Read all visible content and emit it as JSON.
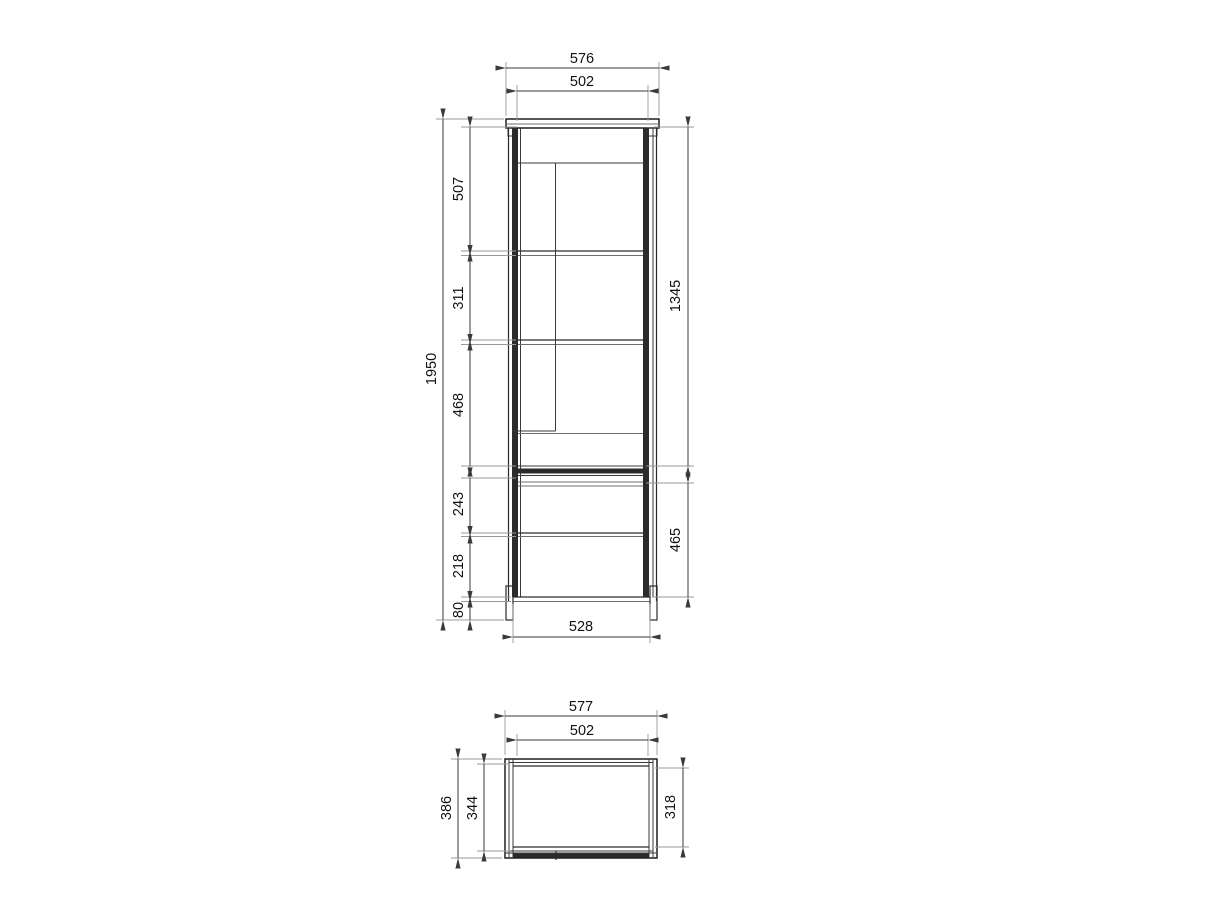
{
  "drawing": {
    "front_view": {
      "overall_width": "576",
      "inner_width": "502",
      "overall_height": "1950",
      "section_top": "507",
      "section_middle": "311",
      "section_lower": "468",
      "section_drawer": "243",
      "section_bottom": "218",
      "plinth_height": "80",
      "door_height": "1345",
      "lower_unit_height": "465",
      "base_width": "528"
    },
    "top_view": {
      "overall_width": "577",
      "inner_width": "502",
      "overall_depth": "386",
      "inner_depth": "344",
      "opening_depth": "318"
    },
    "colors": {
      "line": "#1f1f1f",
      "dimension": "#3a3a3a",
      "extension": "#999999",
      "background": "#ffffff"
    }
  }
}
